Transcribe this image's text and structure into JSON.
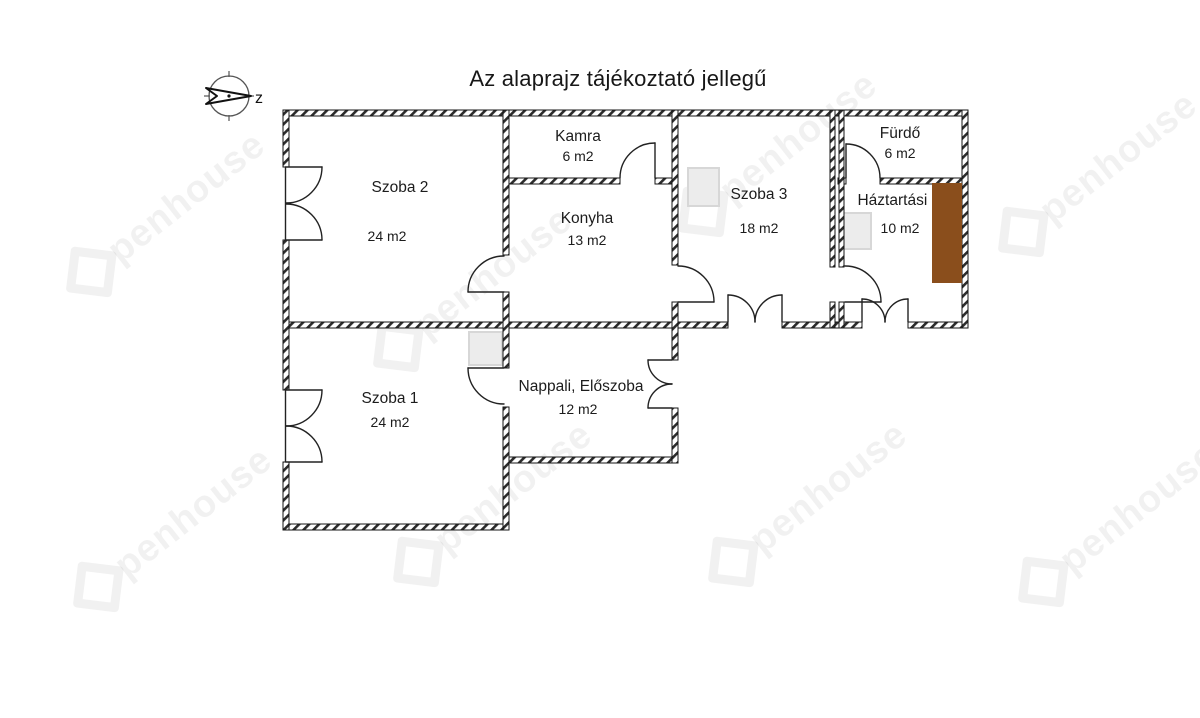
{
  "title": "Az alaprajz tájékoztató jellegű",
  "compass": {
    "label": "z"
  },
  "watermark": {
    "text": "penhouse"
  },
  "colors": {
    "wall": "#1c1c1c",
    "counter_brown": "#8a4e1c",
    "stove_gray": "#ececec",
    "watermark_gray": "#ededed"
  },
  "rooms": [
    {
      "id": "szoba2",
      "name": "Szoba 2",
      "area": "24 m2"
    },
    {
      "id": "kamra",
      "name": "Kamra",
      "area": "6 m2"
    },
    {
      "id": "konyha",
      "name": "Konyha",
      "area": "13 m2"
    },
    {
      "id": "szoba3",
      "name": "Szoba 3",
      "area": "18 m2"
    },
    {
      "id": "furdo",
      "name": "Fürdő",
      "area": "6 m2"
    },
    {
      "id": "haztartasi",
      "name": "Háztartási h.",
      "area": "10 m2"
    },
    {
      "id": "szoba1",
      "name": "Szoba 1",
      "area": "24 m2"
    },
    {
      "id": "nappali",
      "name": "Nappali, Előszoba",
      "area": "12 m2"
    }
  ]
}
